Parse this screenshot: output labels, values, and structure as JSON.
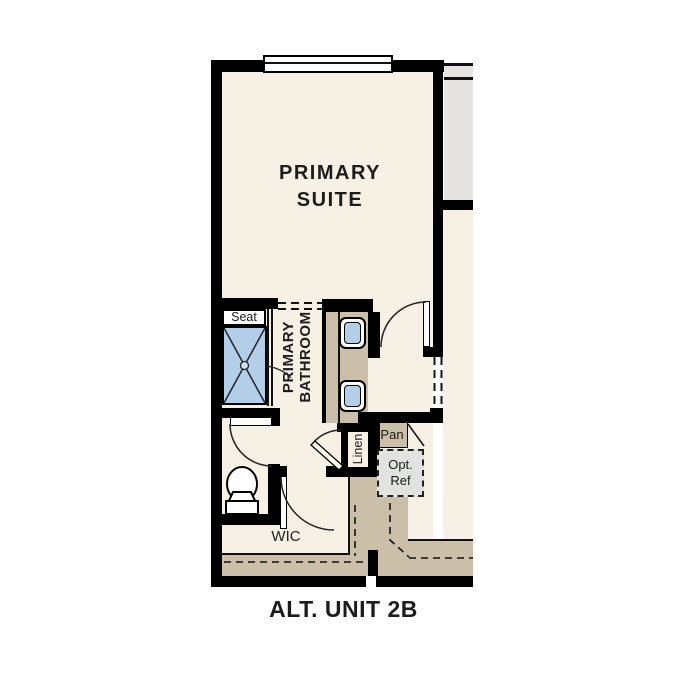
{
  "title": "ALT. UNIT 2B",
  "rooms": {
    "primary_suite": {
      "line1": "PRIMARY",
      "line2": "SUITE"
    },
    "primary_bathroom": {
      "line1": "PRIMARY",
      "line2": "BATHROOM"
    },
    "wic": "WIC"
  },
  "fixtures": {
    "seat": "Seat",
    "linen": "Linen",
    "pantry": "Pan",
    "opt_ref": {
      "line1": "Opt.",
      "line2": "Ref"
    }
  },
  "colors": {
    "wall": "#000000",
    "floor": "#f7f0e4",
    "counter_tan": "#cbbfa9",
    "fixture_blue": "#b3cee9",
    "adjacent_gray": "#e6e4e1",
    "opt_ref_gray": "#e1e3e0"
  }
}
